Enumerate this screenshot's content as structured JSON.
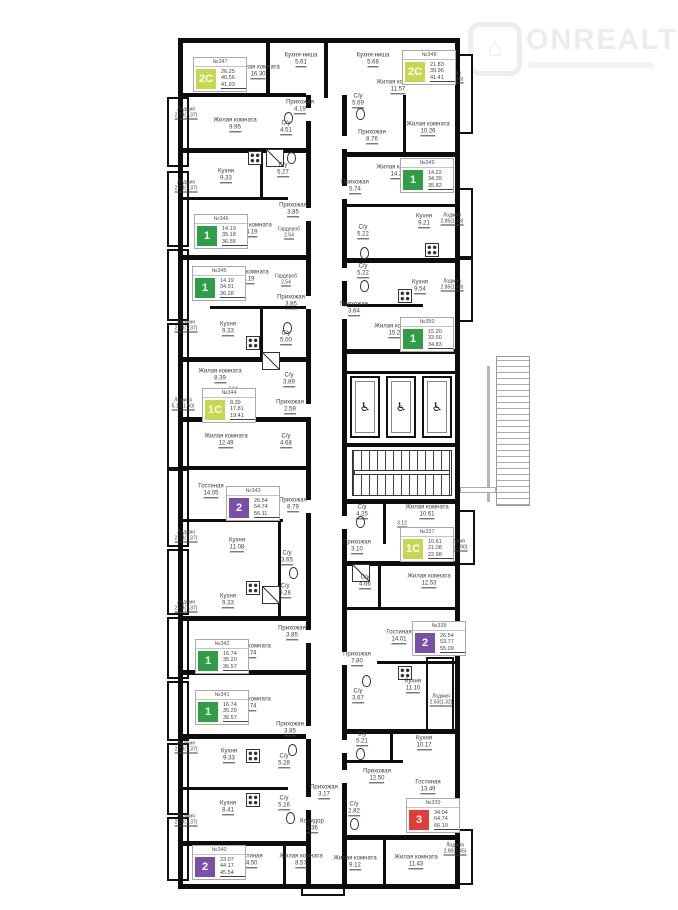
{
  "logo": {
    "brand": "ONREALT",
    "icon": "⌂"
  },
  "core": {
    "elevators": 3,
    "accessible_icon": "♿"
  },
  "apartments": [
    {
      "number": "№347",
      "type": "2С",
      "color": "#c5d84e",
      "living": "26.25",
      "area": "40.56",
      "total": "41.93",
      "x": 193,
      "y": 57
    },
    {
      "number": "№348",
      "type": "2С",
      "color": "#c5d84e",
      "living": "21.83",
      "area": "39.96",
      "total": "41.41",
      "x": 402,
      "y": 50
    },
    {
      "number": "№349",
      "type": "1",
      "color": "#2f9e44",
      "living": "14.22",
      "area": "34.39",
      "total": "35.82",
      "x": 400,
      "y": 158
    },
    {
      "number": "№346",
      "type": "1",
      "color": "#2f9e44",
      "living": "14.19",
      "area": "35.18",
      "total": "36.55",
      "x": 194,
      "y": 214
    },
    {
      "number": "№345",
      "type": "1",
      "color": "#2f9e44",
      "living": "14.19",
      "area": "34.91",
      "total": "36.28",
      "x": 192,
      "y": 266
    },
    {
      "number": "№350",
      "type": "1",
      "color": "#2f9e44",
      "living": "15.20",
      "area": "33.60",
      "total": "34.83",
      "x": 400,
      "y": 317
    },
    {
      "number": "№344",
      "type": "1С",
      "color": "#c5d84e",
      "living": "8.39",
      "area": "17.81",
      "total": "19.41",
      "x": 202,
      "y": 388
    },
    {
      "number": "№343",
      "type": "2",
      "color": "#7a4fa8",
      "living": "26.54",
      "area": "54.74",
      "total": "56.11",
      "x": 226,
      "y": 486
    },
    {
      "number": "№337",
      "type": "1С",
      "color": "#c5d84e",
      "living": "10.61",
      "area": "21.08",
      "total": "22.98",
      "x": 400,
      "y": 527
    },
    {
      "number": "№338",
      "type": "2",
      "color": "#7a4fa8",
      "living": "26.54",
      "area": "53.77",
      "total": "55.09",
      "x": 412,
      "y": 621
    },
    {
      "number": "№342",
      "type": "1",
      "color": "#2f9e44",
      "living": "16.74",
      "area": "35.20",
      "total": "36.57",
      "x": 195,
      "y": 639
    },
    {
      "number": "№341",
      "type": "1",
      "color": "#2f9e44",
      "living": "16.74",
      "area": "35.20",
      "total": "36.57",
      "x": 195,
      "y": 690
    },
    {
      "number": "№339",
      "type": "3",
      "color": "#e23c38",
      "living": "34.04",
      "area": "64.74",
      "total": "66.19",
      "x": 406,
      "y": 798
    },
    {
      "number": "№340",
      "type": "2",
      "color": "#7a4fa8",
      "living": "23.07",
      "area": "44.17",
      "total": "45.54",
      "x": 192,
      "y": 845
    }
  ],
  "rooms": [
    {
      "label": "Кухня-ниша",
      "area": "5.61",
      "x": 301,
      "y": 60
    },
    {
      "label": "Жилая комната",
      "area": "16.30",
      "x": 258,
      "y": 72
    },
    {
      "label": "Лоджия",
      "area": "2.73(1.37)",
      "x": 186,
      "y": 113,
      "s": 1
    },
    {
      "label": "Жилая комната",
      "area": "9.95",
      "x": 235,
      "y": 125
    },
    {
      "label": "Прихожая",
      "area": "4.19",
      "x": 300,
      "y": 107
    },
    {
      "label": "С/у",
      "area": "4.51",
      "x": 286,
      "y": 128
    },
    {
      "label": "Кухня-ниша",
      "area": "5.68",
      "x": 373,
      "y": 60
    },
    {
      "label": "Жилая комната",
      "area": "11.57",
      "x": 398,
      "y": 87
    },
    {
      "label": "Лоджия",
      "area": "2.90(1.45)",
      "x": 452,
      "y": 77,
      "s": 1
    },
    {
      "label": "С/у",
      "area": "5.69",
      "x": 358,
      "y": 101
    },
    {
      "label": "Прихожая",
      "area": "8.76",
      "x": 372,
      "y": 137
    },
    {
      "label": "Жилая комната",
      "area": "10.26",
      "x": 428,
      "y": 129
    },
    {
      "label": "Кухня",
      "area": "9.33",
      "x": 226,
      "y": 176
    },
    {
      "label": "С/у",
      "area": "5.27",
      "x": 283,
      "y": 170
    },
    {
      "label": "Лоджия",
      "area": "2.73(1.37)",
      "x": 186,
      "y": 186,
      "s": 1
    },
    {
      "label": "Жилая комната",
      "area": "14.19",
      "x": 250,
      "y": 230
    },
    {
      "label": "Прихожая",
      "area": "3.85",
      "x": 293,
      "y": 210
    },
    {
      "label": "Гардероб",
      "area": "2.54",
      "x": 289,
      "y": 233,
      "s": 1
    },
    {
      "label": "Прихожая",
      "area": "5.74",
      "x": 355,
      "y": 187
    },
    {
      "label": "Жилая комната",
      "area": "14.22",
      "x": 398,
      "y": 172
    },
    {
      "label": "Кухня",
      "area": "9.21",
      "x": 424,
      "y": 221
    },
    {
      "label": "Лоджия",
      "area": "2.85(1.43)",
      "x": 452,
      "y": 219,
      "s": 1
    },
    {
      "label": "С/у",
      "area": "5.22",
      "x": 363,
      "y": 232
    },
    {
      "label": "Жилая комната",
      "area": "14.19",
      "x": 247,
      "y": 277
    },
    {
      "label": "Гардероб",
      "area": "2.54",
      "x": 286,
      "y": 280,
      "s": 1
    },
    {
      "label": "Прихожая",
      "area": "3.85",
      "x": 291,
      "y": 302
    },
    {
      "label": "Кухня",
      "area": "9.33",
      "x": 228,
      "y": 329
    },
    {
      "label": "Лоджия",
      "area": "2.73(1.37)",
      "x": 186,
      "y": 326,
      "s": 1
    },
    {
      "label": "С/у",
      "area": "5.00",
      "x": 286,
      "y": 338
    },
    {
      "label": "С/у",
      "area": "5.22",
      "x": 363,
      "y": 271
    },
    {
      "label": "Кухня",
      "area": "9.54",
      "x": 420,
      "y": 287
    },
    {
      "label": "Лоджия",
      "area": "2.85(1.43)",
      "x": 452,
      "y": 285,
      "s": 1
    },
    {
      "label": "Прихожая",
      "area": "3.64",
      "x": 354,
      "y": 309
    },
    {
      "label": "Жилая комната",
      "area": "15.20",
      "x": 396,
      "y": 331
    },
    {
      "label": "Жилая комната",
      "area": "8.39",
      "x": 220,
      "y": 376
    },
    {
      "label": "",
      "area": "2.94",
      "x": 233,
      "y": 390,
      "s": 1
    },
    {
      "label": "С/у",
      "area": "3.89",
      "x": 289,
      "y": 380
    },
    {
      "label": "Лоджия",
      "area": "5.19(1.60)",
      "x": 183,
      "y": 404,
      "s": 1
    },
    {
      "label": "Прихожая",
      "area": "2.59",
      "x": 290,
      "y": 407
    },
    {
      "label": "Жилая комната",
      "area": "12.49",
      "x": 226,
      "y": 441
    },
    {
      "label": "С/у",
      "area": "4.68",
      "x": 286,
      "y": 441
    },
    {
      "label": "Гостиная",
      "area": "14.05",
      "x": 211,
      "y": 491
    },
    {
      "label": "Прихожая",
      "area": "8.79",
      "x": 293,
      "y": 505
    },
    {
      "label": "Кухня",
      "area": "11.08",
      "x": 237,
      "y": 545
    },
    {
      "label": "Лоджия",
      "area": "2.73(1.37)",
      "x": 186,
      "y": 536,
      "s": 1
    },
    {
      "label": "С/у",
      "area": "3.65",
      "x": 287,
      "y": 558
    },
    {
      "label": "С/у",
      "area": "5.28",
      "x": 285,
      "y": 591
    },
    {
      "label": "Кухня",
      "area": "9.33",
      "x": 228,
      "y": 601
    },
    {
      "label": "Лоджия",
      "area": "2.73(1.37)",
      "x": 186,
      "y": 606,
      "s": 1
    },
    {
      "label": "Жилая комната",
      "area": "16.74",
      "x": 249,
      "y": 651
    },
    {
      "label": "Прихожая",
      "area": "3.85",
      "x": 292,
      "y": 633
    },
    {
      "label": "С/у",
      "area": "4.25",
      "x": 362,
      "y": 512
    },
    {
      "label": "Жилая комната",
      "area": "10.61",
      "x": 427,
      "y": 512
    },
    {
      "label": "",
      "area": "3.12",
      "x": 402,
      "y": 524,
      "s": 1
    },
    {
      "label": "Прихожая",
      "area": "3.10",
      "x": 357,
      "y": 547
    },
    {
      "label": "Лоджия",
      "area": "3.80(1.90)",
      "x": 456,
      "y": 545,
      "s": 1
    },
    {
      "label": "С/у",
      "area": "4.66",
      "x": 365,
      "y": 582
    },
    {
      "label": "Жилая комната",
      "area": "12.53",
      "x": 429,
      "y": 581
    },
    {
      "label": "Гостиная",
      "area": "14.01",
      "x": 399,
      "y": 637
    },
    {
      "label": "Прихожая",
      "area": "7.80",
      "x": 357,
      "y": 659
    },
    {
      "label": "Кухня",
      "area": "11.10",
      "x": 413,
      "y": 686
    },
    {
      "label": "Лоджия",
      "area": "2.63(1.32)",
      "x": 441,
      "y": 700,
      "s": 1
    },
    {
      "label": "С/у",
      "area": "3.67",
      "x": 358,
      "y": 696
    },
    {
      "label": "Жилая комната",
      "area": "16.74",
      "x": 249,
      "y": 704
    },
    {
      "label": "Прихожая",
      "area": "3.85",
      "x": 290,
      "y": 729
    },
    {
      "label": "Лоджия",
      "area": "2.73(1.37)",
      "x": 186,
      "y": 747,
      "s": 1
    },
    {
      "label": "Кухня",
      "area": "9.33",
      "x": 229,
      "y": 756
    },
    {
      "label": "С/у",
      "area": "5.28",
      "x": 284,
      "y": 761
    },
    {
      "label": "Кухня",
      "area": "8.41",
      "x": 228,
      "y": 808
    },
    {
      "label": "С/у",
      "area": "5.16",
      "x": 284,
      "y": 803
    },
    {
      "label": "Лоджия",
      "area": "2.73(1.37)",
      "x": 186,
      "y": 820,
      "s": 1
    },
    {
      "label": "Прихожая",
      "area": "3.17",
      "x": 324,
      "y": 792
    },
    {
      "label": "Коридор",
      "area": "4.36",
      "x": 312,
      "y": 826
    },
    {
      "label": "Гостиная",
      "area": "14.50",
      "x": 250,
      "y": 861
    },
    {
      "label": "Жилая комната",
      "area": "8.57",
      "x": 301,
      "y": 861
    },
    {
      "label": "С/у",
      "area": "5.21",
      "x": 362,
      "y": 739
    },
    {
      "label": "Кухня",
      "area": "10.17",
      "x": 424,
      "y": 743
    },
    {
      "label": "Прихожая",
      "area": "12.50",
      "x": 377,
      "y": 776
    },
    {
      "label": "Гостиная",
      "area": "13.49",
      "x": 428,
      "y": 787
    },
    {
      "label": "С/у",
      "area": "2.82",
      "x": 354,
      "y": 809
    },
    {
      "label": "Жилая комната",
      "area": "9.12",
      "x": 355,
      "y": 863
    },
    {
      "label": "Жилая комната",
      "area": "11.43",
      "x": 416,
      "y": 862
    },
    {
      "label": "Лоджия",
      "area": "2.90(1.45)",
      "x": 455,
      "y": 849,
      "s": 1
    }
  ]
}
